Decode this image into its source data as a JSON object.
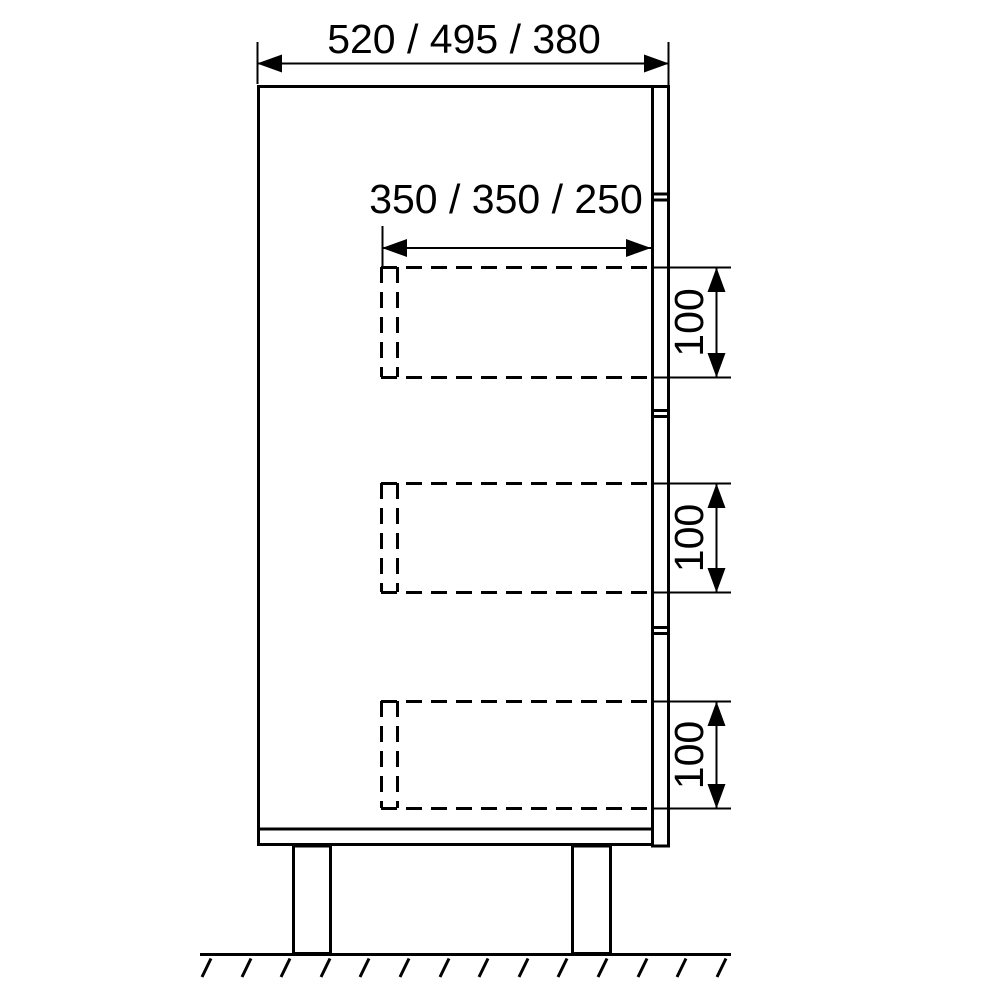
{
  "page": {
    "background_color": "#ffffff",
    "line_color": "#000000"
  },
  "drawing": {
    "type": "cabinet-side-elevation-technical-drawing",
    "labels": {
      "overall_width": "520 / 495 / 380",
      "drawer_depth": "350 / 350 / 250",
      "drawer_heights": [
        "100",
        "100",
        "100"
      ]
    }
  }
}
